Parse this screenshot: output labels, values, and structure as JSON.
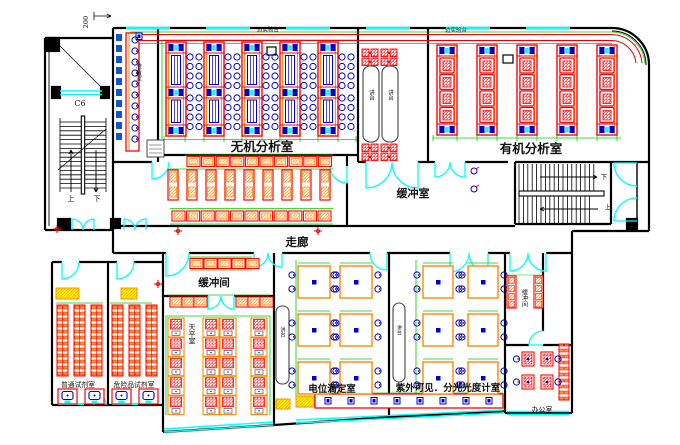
{
  "meta": {
    "drawing_type": "laboratory floor plan CAD drawing"
  },
  "rooms": {
    "inorganic_lab": "无机分析室",
    "organic_lab": "有机分析室",
    "buffer_room": "缓冲室",
    "corridor": "走廊",
    "buffer_lobby": "缓冲间",
    "balance_room": "天平室",
    "titration_room": "电位滴定室",
    "uv_room": "紫外可见．分光光度计室",
    "office": "办公室",
    "general_reagent_room": "普通试剂室",
    "hazard_reagent_room": "危险品试剂室",
    "small_buffer_room": "缓冲间",
    "prep_room": "准备室"
  },
  "furniture": {
    "podium": "讲台",
    "side_bench": "边实验台"
  },
  "stairs": {
    "up": "上",
    "down": "下"
  },
  "annotations": {
    "window_tag": "C6",
    "dimension": "200"
  },
  "colors": {
    "wall": "#000000",
    "door_window": "#00ffff",
    "bench": "#ff0000",
    "bench_secondary": "#ff8000",
    "equipment": "#0000cc",
    "dimension": "#00cc00",
    "cabinet": "#ffff00"
  }
}
